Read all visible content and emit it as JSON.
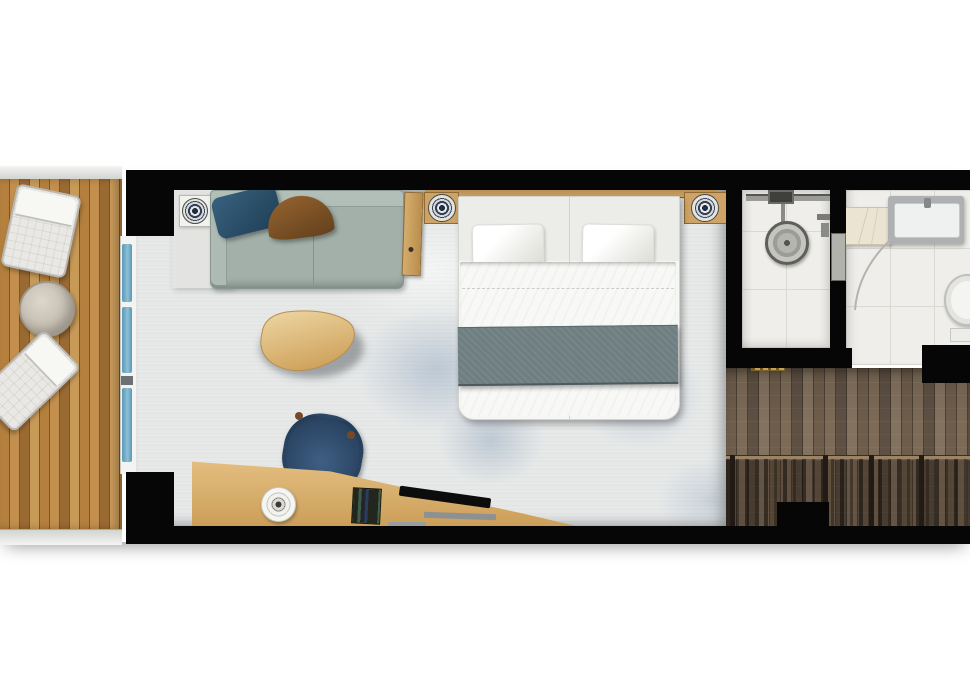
{
  "scene": {
    "type": "floor-plan",
    "subject": "hotel-cabin-with-balcony-top-down",
    "background": "#ffffff"
  },
  "colors": {
    "wall": "#060606",
    "carpet": "#e7e9e9",
    "carpet-mottle": "#92a8c0",
    "deck-wood-light": "#c28f4e",
    "deck-wood-dark": "#8f6230",
    "balcony-rail": "#dfe1de",
    "window-glass": "#6fa8c4",
    "sofa-fabric": "#a3b0aa",
    "cushion-blue": "#2c5571",
    "cushion-brown": "#85562b",
    "furniture-wood": "#cda367",
    "coffee-table-wood": "#e0bc85",
    "bed-linen": "#f6f6f4",
    "throw-blanket": "#6f7e81",
    "desk-chair-blue": "#2b4563",
    "tile": "#efeeea",
    "corridor-wood": "#6e5d4b",
    "wardrobe-dark": "#221b15",
    "threshold-gold": "#c5a24e"
  },
  "rooms": {
    "balcony": {
      "items": [
        "lounge-chair",
        "round-side-table",
        "lounge-chair"
      ]
    },
    "living_area": {
      "items": [
        "sofa",
        "blue-cushion",
        "brown-cushion",
        "console-table",
        "coffee-table",
        "desk",
        "desk-chair",
        "round-tray",
        "book-stack",
        "tv",
        "ceiling-light-medallion"
      ]
    },
    "sleeping_area": {
      "items": [
        "headboard",
        "nightstand-left",
        "nightstand-right",
        "double-bed",
        "pillow",
        "pillow",
        "duvet",
        "throw-blanket"
      ]
    },
    "shower_room": {
      "items": [
        "shower-rail",
        "shower-control",
        "rain-shower-head",
        "shower-handle",
        "wall-niche"
      ]
    },
    "bathroom": {
      "items": [
        "shelf",
        "vanity-sink",
        "faucet",
        "toilet",
        "door-swing-arc"
      ]
    },
    "entry_corridor": {
      "items": [
        "threshold",
        "wardrobe-rod",
        "wardrobe-clothes",
        "entry-door-recess"
      ]
    }
  }
}
